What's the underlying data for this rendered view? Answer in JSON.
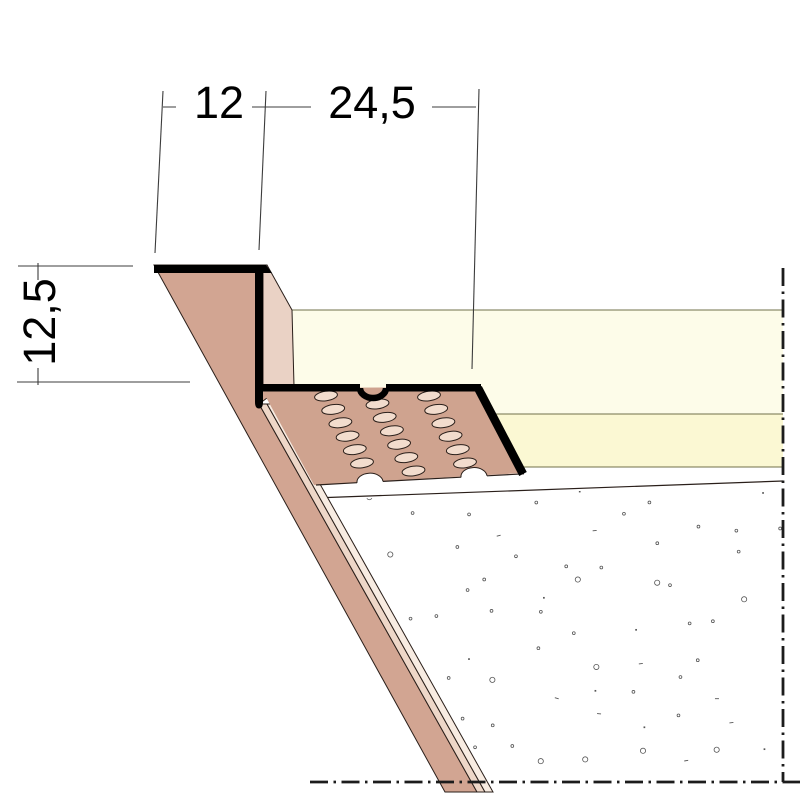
{
  "drawing": {
    "kind": "shadow-gap perforated drywall profile cross-section",
    "dimensions": {
      "top_left": "12",
      "top_right": "24,5",
      "left": "12,5"
    }
  },
  "colors": {
    "bg": "#ffffff",
    "ink": "#000000",
    "board": "#d2a592",
    "flange": "#cfa38f",
    "edge_light": "#eed7c8",
    "edge_lighter": "#f8ece2",
    "leg_face": "#ead2c5",
    "hole": "#f2dccd",
    "cream1": "#fdfce9",
    "cream2": "#fbf8d3",
    "cream_line": "#70704a",
    "thin": "#2a1f1a",
    "dim": "#3c3c3c",
    "dashdot": "#1c1c1c",
    "stipple": "#555555"
  },
  "perforation": {
    "cols": 3,
    "rows": 6,
    "origin_x": 326,
    "origin_y": 396,
    "col_dx": 51.5,
    "stagger_y": 8,
    "row_dx": 7.2,
    "row_dy": 13.4,
    "rx": 11.5,
    "ry": 4.8,
    "tilt": -8
  },
  "stipple": {
    "x0": 318,
    "x1": 782,
    "y0": 490,
    "y1": 778,
    "step_x": 46,
    "step_y": 33,
    "seed": 7,
    "skip_ratio": 0.12
  }
}
